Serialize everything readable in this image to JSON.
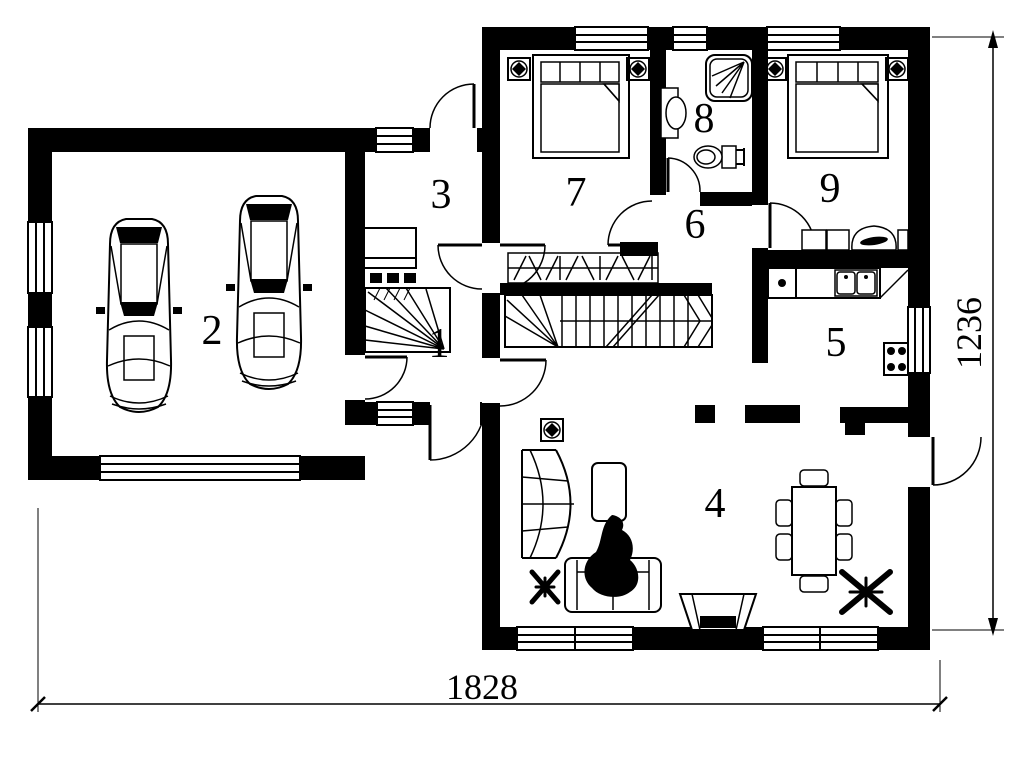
{
  "title": "House ground floor plan",
  "rooms": [
    {
      "label": "1"
    },
    {
      "label": "2"
    },
    {
      "label": "3"
    },
    {
      "label": "4"
    },
    {
      "label": "5"
    },
    {
      "label": "6"
    },
    {
      "label": "7"
    },
    {
      "label": "8"
    },
    {
      "label": "9"
    }
  ],
  "dimensions": {
    "width_label": "1828",
    "height_label": "1236"
  },
  "colors": {
    "ink": "#000000",
    "paper": "#ffffff"
  }
}
